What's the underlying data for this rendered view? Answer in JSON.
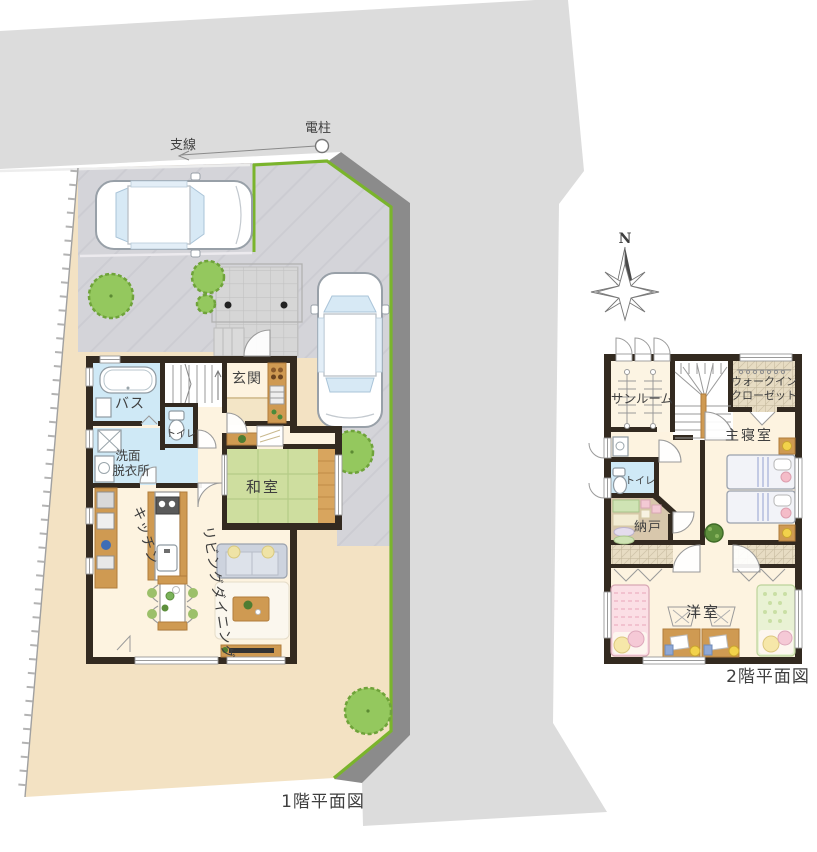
{
  "colors": {
    "road": "#dcdcdc",
    "retaining_wall": "#8b8b8b",
    "boundary_green": "#7ab42c",
    "site": "#f3e2c3",
    "parking": "#d4d4d9",
    "wall": "#332a20",
    "floor": "#fdf3e0",
    "water": "#cfe9f6",
    "tatami": "#cede9f",
    "wood": "#cf9a52",
    "tree": "#94c85e"
  },
  "annotations": {
    "support_wire": "支線",
    "utility_pole": "電柱",
    "compass_north": "N"
  },
  "floor1": {
    "caption": "1階平面図",
    "rooms": {
      "genkan": "玄関",
      "bath": "バス",
      "toilet": "トイレ",
      "washroom_line1": "洗面",
      "washroom_line2": "脱衣所",
      "washitsu": "和室",
      "kitchen": "キッチン",
      "living_dining": "リビングダイニング"
    }
  },
  "floor2": {
    "caption": "2階平面図",
    "rooms": {
      "sunroom": "サンルーム",
      "walk_in_closet_line1": "ウォークイン",
      "walk_in_closet_line2": "クローゼット",
      "master_bedroom": "主寝室",
      "toilet": "トイレ",
      "storage": "納戸",
      "western_room": "洋室"
    }
  }
}
